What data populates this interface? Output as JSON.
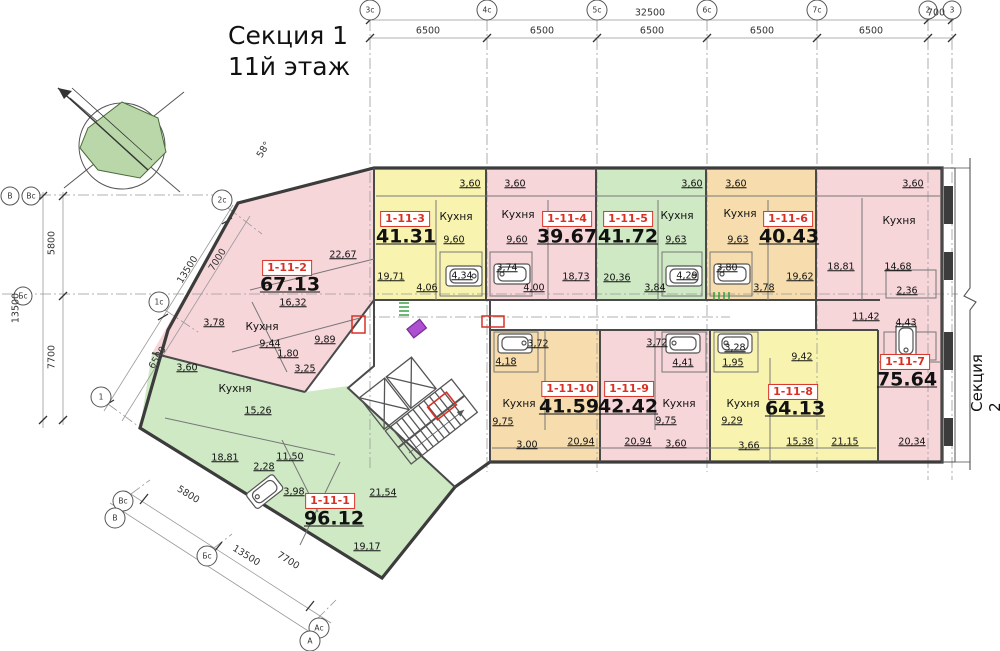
{
  "title": {
    "line1": "Секция 1",
    "line2": "11й этаж"
  },
  "labels": {
    "kitchen": "Кухня",
    "section2": "Секция 2",
    "angle": "58°"
  },
  "axes": {
    "top": [
      "3с",
      "4с",
      "5с",
      "6с",
      "7с",
      "2",
      "3"
    ],
    "left": [
      "В",
      "Вс",
      "Бс"
    ],
    "diag_upper": [
      "2с",
      "1с",
      "1"
    ],
    "diag_lower": [
      "Вс",
      "В",
      "Бс",
      "Ас",
      "А"
    ]
  },
  "dimensions": {
    "top_total": "32500",
    "top_right": "700",
    "top_segments": [
      "6500",
      "6500",
      "6500",
      "6500",
      "6500"
    ],
    "left_vertical": [
      "5800",
      "13500",
      "7700"
    ],
    "diag_upper": [
      "7000",
      "13500",
      "6500"
    ],
    "diag_lower": [
      "5800",
      "13500",
      "7700"
    ]
  },
  "apartments": [
    {
      "id": "1-11-1",
      "area": "96.12",
      "rooms": [
        "3,60",
        "15,26",
        "18,81",
        "11,50",
        "2,28",
        "3,98",
        "21,54",
        "19,17"
      ]
    },
    {
      "id": "1-11-2",
      "area": "67.13",
      "rooms": [
        "22,67",
        "16,32",
        "9,44",
        "9,89",
        "1,80",
        "3,25",
        "3,78"
      ]
    },
    {
      "id": "1-11-3",
      "area": "41.31",
      "rooms": [
        "3,60",
        "9,60",
        "19,71",
        "4,06",
        "4,34"
      ]
    },
    {
      "id": "1-11-4",
      "area": "39.67",
      "rooms": [
        "3,60",
        "9,60",
        "3,74",
        "4,00",
        "18,73"
      ]
    },
    {
      "id": "1-11-5",
      "area": "41.72",
      "rooms": [
        "3,60",
        "9,63",
        "20,36",
        "3,84",
        "4,29"
      ]
    },
    {
      "id": "1-11-6",
      "area": "40.43",
      "rooms": [
        "3,60",
        "9,63",
        "3,80",
        "3,78",
        "19,62"
      ]
    },
    {
      "id": "1-11-7",
      "area": "75.64",
      "rooms": [
        "3,60",
        "14,68",
        "18,81",
        "2,36",
        "11,42",
        "4,43",
        "20,34"
      ]
    },
    {
      "id": "1-11-8",
      "area": "64.13",
      "rooms": [
        "3,28",
        "1,95",
        "9,42",
        "9,29",
        "3,66",
        "15,38",
        "21,15"
      ]
    },
    {
      "id": "1-11-9",
      "area": "42.42",
      "rooms": [
        "3,72",
        "4,41",
        "9,75",
        "20,94",
        "3,60"
      ]
    },
    {
      "id": "1-11-10",
      "area": "41.59",
      "rooms": [
        "3,72",
        "4,18",
        "9,75",
        "3,00",
        "20,94"
      ]
    }
  ],
  "colors": {
    "pink": "#f7d6da",
    "yellow": "#f8f4b0",
    "green": "#cfe9c5",
    "orange": "#f7ddad",
    "wall": "#3c3c3c",
    "accent_red": "#d93025",
    "site_green": "#b9d7a8"
  }
}
